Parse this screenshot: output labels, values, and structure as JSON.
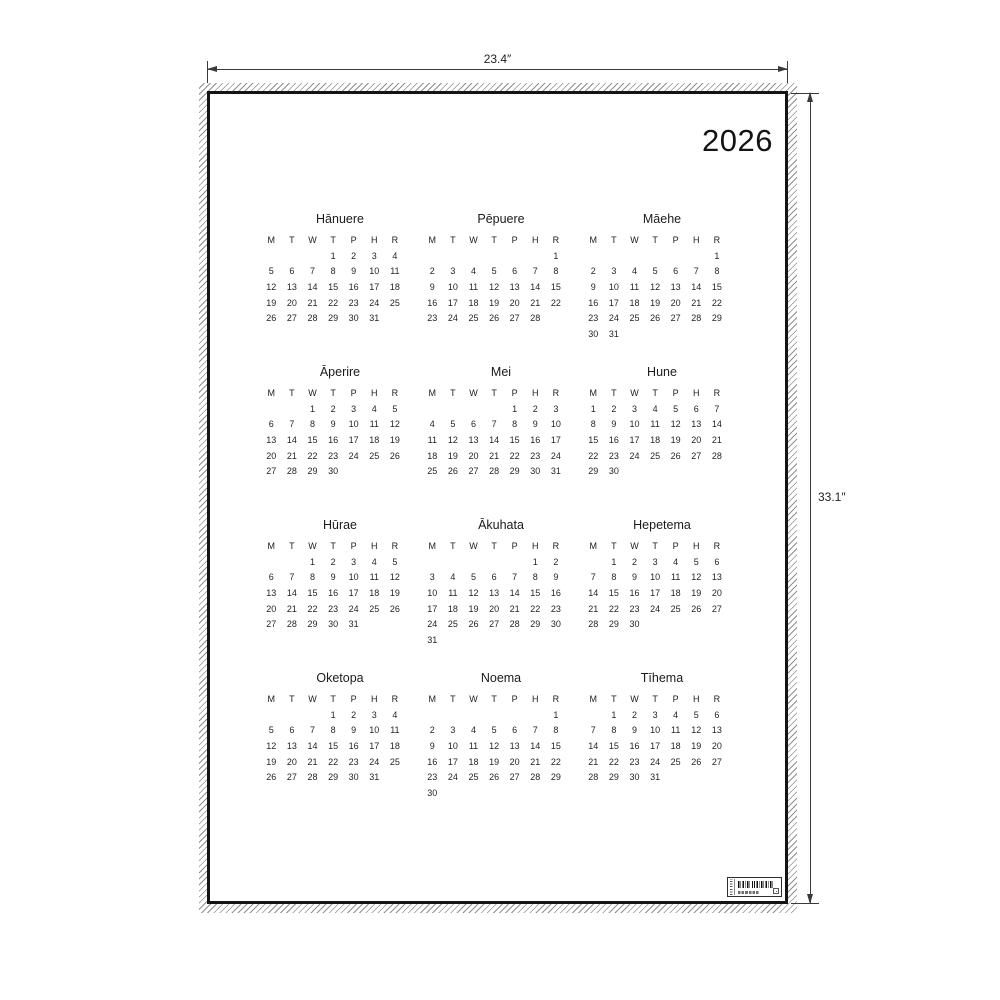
{
  "poster": {
    "year": "2026",
    "day_headers": [
      "M",
      "T",
      "W",
      "T",
      "P",
      "H",
      "R"
    ],
    "months": [
      {
        "name": "Hānuere",
        "start_offset": 3,
        "num_days": 31
      },
      {
        "name": "Pēpuere",
        "start_offset": 6,
        "num_days": 28
      },
      {
        "name": "Māehe",
        "start_offset": 6,
        "num_days": 31
      },
      {
        "name": "Āperire",
        "start_offset": 2,
        "num_days": 30
      },
      {
        "name": "Mei",
        "start_offset": 4,
        "num_days": 31
      },
      {
        "name": "Hune",
        "start_offset": 0,
        "num_days": 30
      },
      {
        "name": "Hūrae",
        "start_offset": 2,
        "num_days": 31
      },
      {
        "name": "Ākuhata",
        "start_offset": 5,
        "num_days": 31
      },
      {
        "name": "Hepetema",
        "start_offset": 1,
        "num_days": 30
      },
      {
        "name": "Oketopa",
        "start_offset": 3,
        "num_days": 31
      },
      {
        "name": "Noema",
        "start_offset": 6,
        "num_days": 30
      },
      {
        "name": "Tīhema",
        "start_offset": 1,
        "num_days": 31
      }
    ]
  },
  "annotations": {
    "width_label": "23.4″",
    "height_label": "33.1″"
  },
  "colors": {
    "ink": "#1b1b1b",
    "border": "#141414",
    "dimension": "#3a3a3a",
    "hatch": "#8f8f8f",
    "background": "#ffffff"
  }
}
